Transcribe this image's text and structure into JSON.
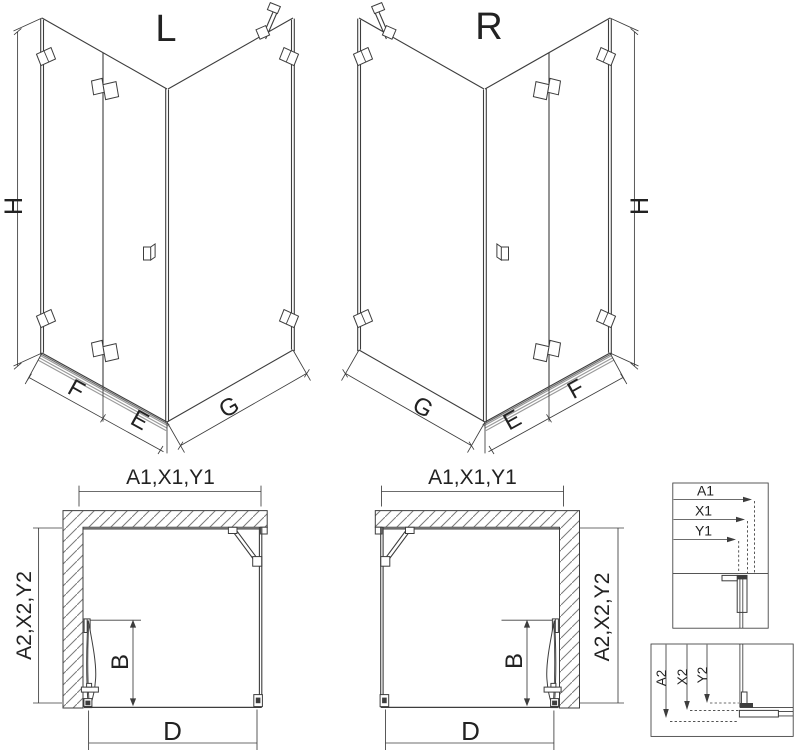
{
  "view_l": {
    "label": "L",
    "dim_height": "H",
    "dim_fixed": "F",
    "dim_door": "E",
    "dim_side": "G"
  },
  "view_r": {
    "label": "R",
    "dim_height": "H",
    "dim_fixed": "F",
    "dim_door": "E",
    "dim_side": "G"
  },
  "plan_l": {
    "dim_width": "A1,X1,Y1",
    "dim_depth": "A2,X2,Y2",
    "dim_door": "B",
    "dim_front": "D"
  },
  "plan_r": {
    "dim_width": "A1,X1,Y1",
    "dim_depth": "A2,X2,Y2",
    "dim_door": "B",
    "dim_front": "D"
  },
  "detail_width": {
    "rows": [
      "A1",
      "X1",
      "Y1"
    ]
  },
  "detail_depth": {
    "rows": [
      "A2",
      "X2",
      "Y2"
    ]
  },
  "colors": {
    "line": "#3d3d3d",
    "threshold": "#9a9a9a",
    "threshold_dark": "#6e6e6e",
    "hatch": "#7a7a7a"
  }
}
